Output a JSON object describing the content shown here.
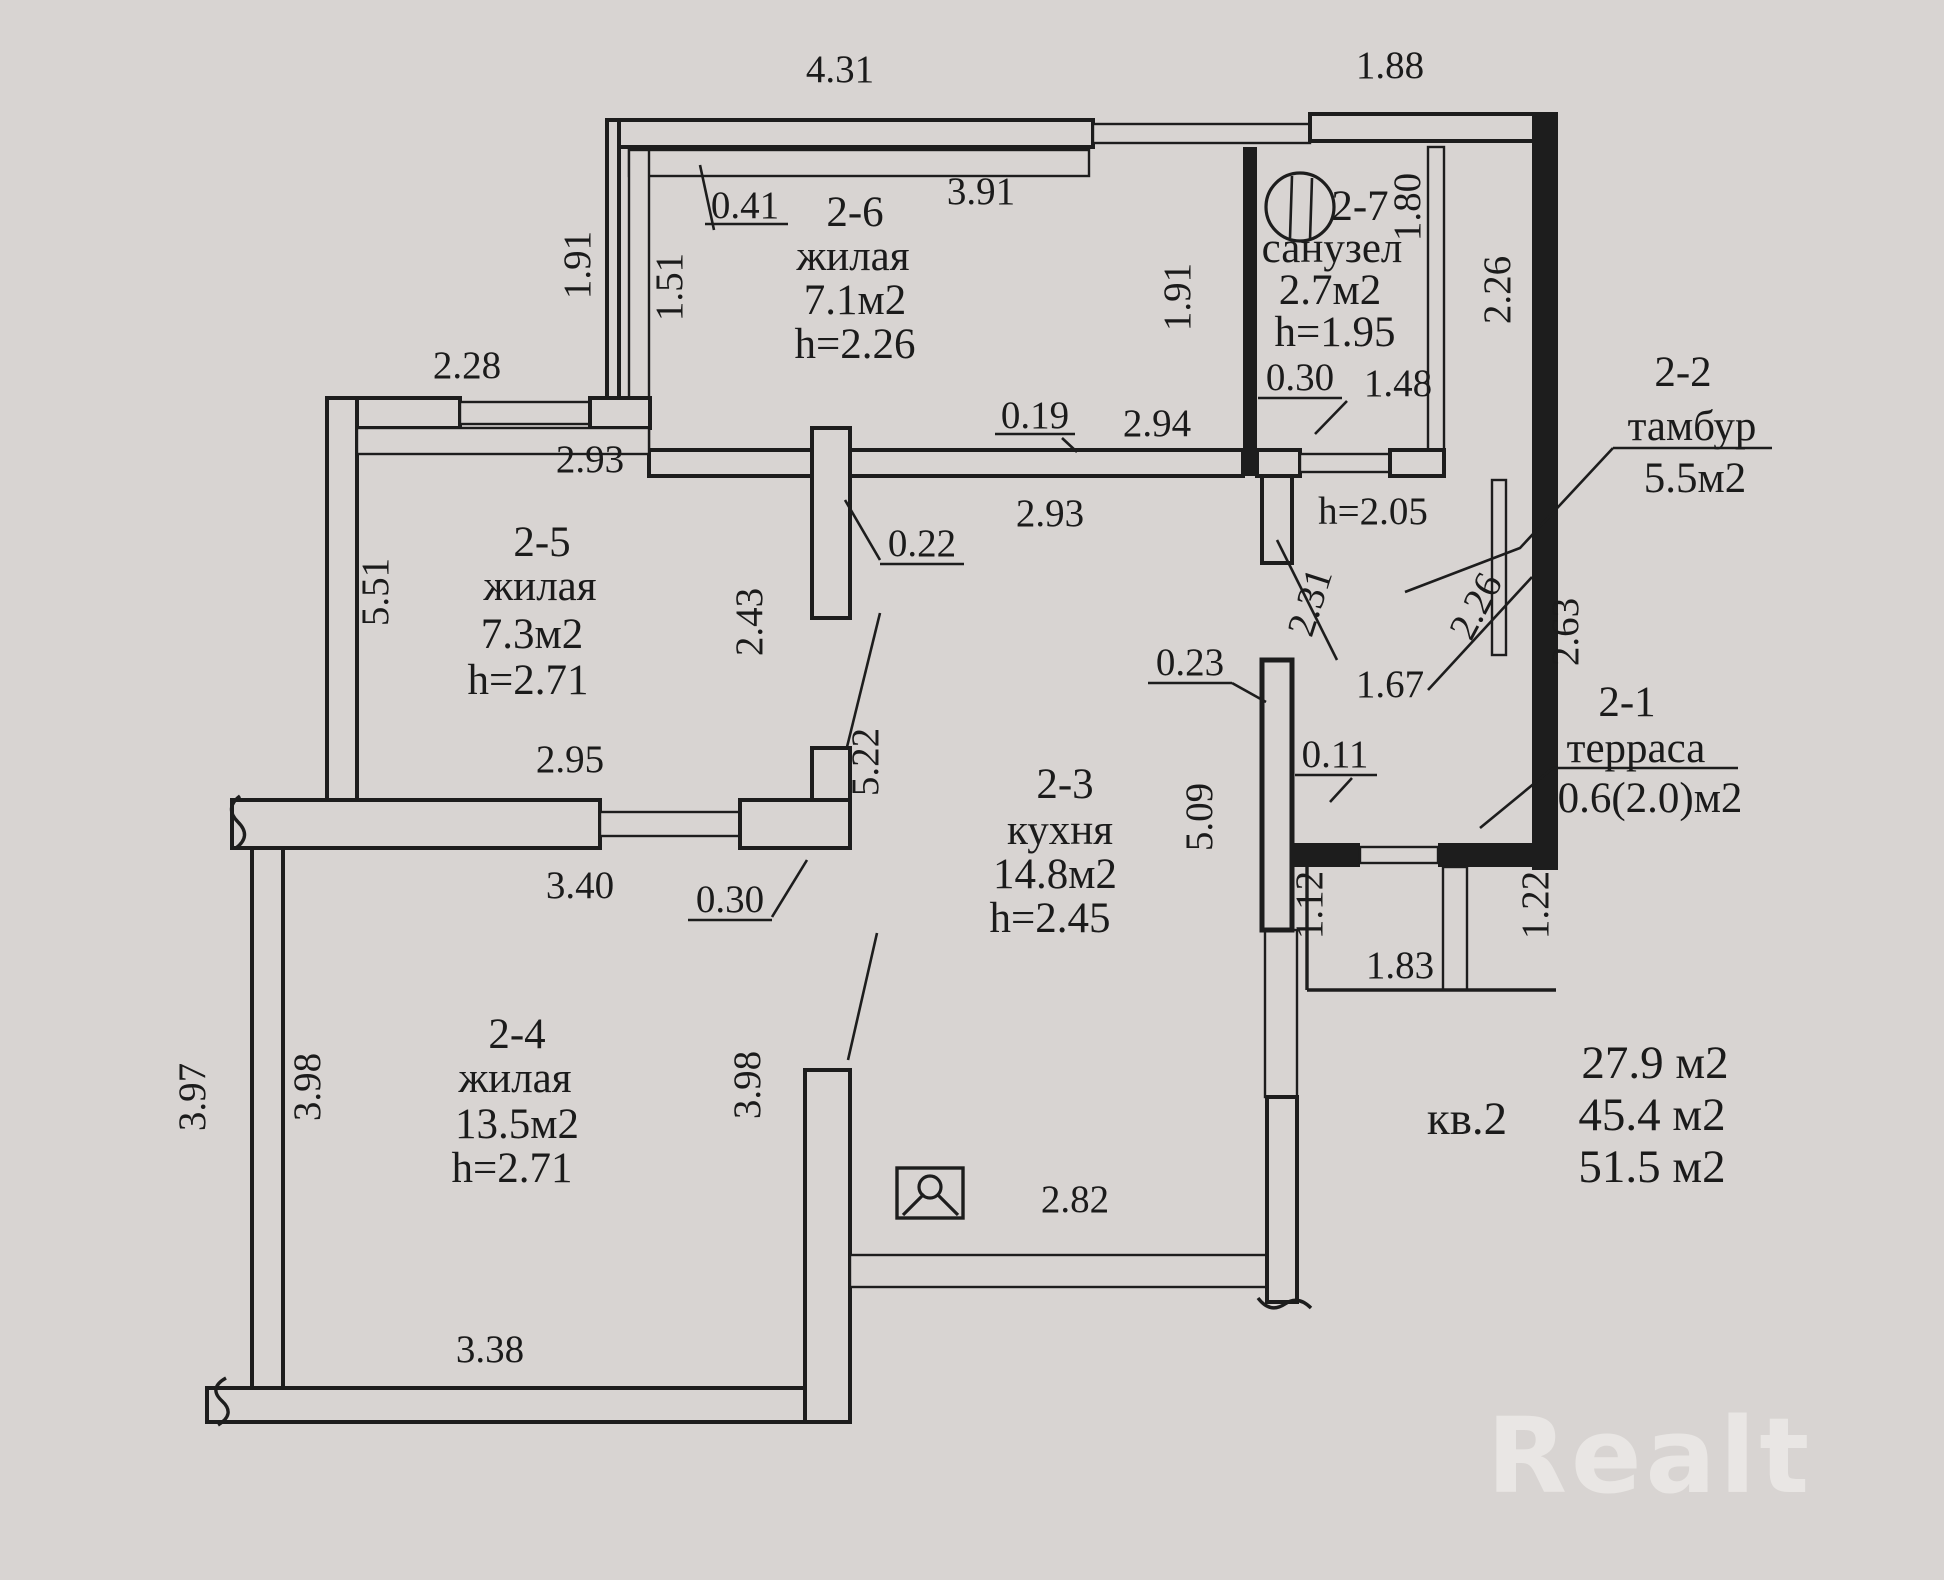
{
  "plan": {
    "colors": {
      "paper": "#d8d4d2",
      "ink": "#1d1d1d",
      "watermark": "#edebe8"
    },
    "icons": {
      "photo": "photo-marker-icon",
      "fixture": "plumbing-fixture-icon"
    },
    "dims": {
      "w431": "4.31",
      "w188": "1.88",
      "h191l": "1.91",
      "h151": "1.51",
      "w041": "0.41",
      "w391": "3.91",
      "h191r": "1.91",
      "h180": "1.80",
      "h226r": "2.26",
      "w030s": "0.30",
      "w148": "1.48",
      "hw205": "h=2.05",
      "w019": "0.19",
      "w294": "2.94",
      "w293k": "2.93",
      "d231": "2.31",
      "d226": "2.26",
      "h263": "2.63",
      "w228": "2.28",
      "w293f": "2.93",
      "h551": "5.51",
      "h243": "2.43",
      "w022": "0.22",
      "w295": "2.95",
      "w023": "0.23",
      "h509": "5.09",
      "w011": "0.11",
      "w167": "1.67",
      "h522": "5.22",
      "h112": "1.12",
      "w183": "1.83",
      "h122": "1.22",
      "w340": "3.40",
      "w030d": "0.30",
      "h397": "3.97",
      "h398l": "3.98",
      "h398r": "3.98",
      "w338": "3.38",
      "w282": "2.82"
    },
    "rooms": {
      "r26": {
        "id": "2-6",
        "type": "жилая",
        "area": "7.1м2",
        "h": "h=2.26"
      },
      "r27": {
        "id": "2-7",
        "type": "санузел",
        "area": "2.7м2",
        "h": "h=1.95"
      },
      "r22": {
        "id": "2-2",
        "type": "тамбур",
        "area": "5.5м2"
      },
      "r25": {
        "id": "2-5",
        "type": "жилая",
        "area": "7.3м2",
        "h": "h=2.71"
      },
      "r23": {
        "id": "2-3",
        "type": "кухня",
        "area": "14.8м2",
        "h": "h=2.45"
      },
      "r24": {
        "id": "2-4",
        "type": "жилая",
        "area": "13.5м2",
        "h": "h=2.71"
      },
      "r21": {
        "id": "2-1",
        "type": "терраса",
        "area": "0.6(2.0)м2"
      }
    },
    "summary": {
      "label": "кв.2",
      "v1": "27.9 м2",
      "v2": "45.4 м2",
      "v3": "51.5 м2"
    },
    "watermark": "Realt"
  }
}
